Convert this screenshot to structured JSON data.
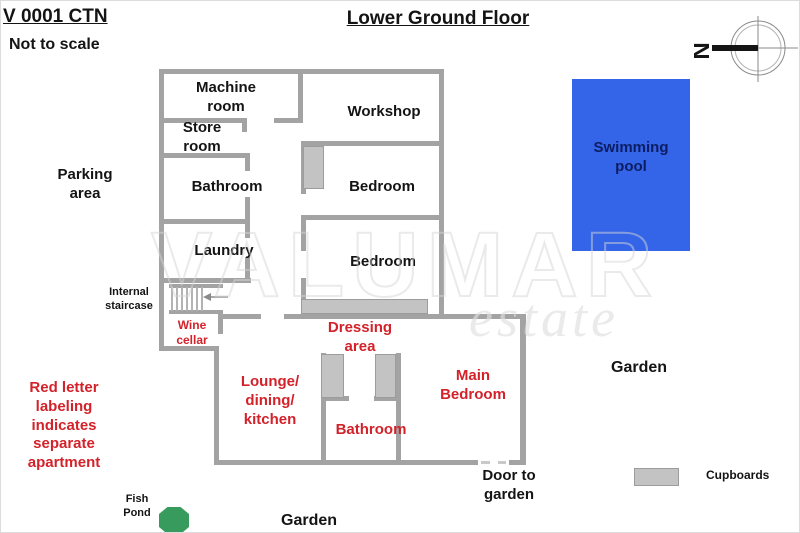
{
  "header": {
    "ref_code": "V 0001 CTN",
    "scale_note": "Not to scale",
    "title": "Lower Ground Floor"
  },
  "compass": {
    "label": "N"
  },
  "watermark": {
    "brand": "VALUMAR",
    "tagline": "estate"
  },
  "plan": {
    "rooms_main_house": {
      "machine_room": "Machine\nroom",
      "workshop": "Workshop",
      "store_room": "Store\nroom",
      "bathroom": "Bathroom",
      "bedroom_upper": "Bedroom",
      "laundry": "Laundry",
      "bedroom_lower": "Bedroom",
      "internal_staircase": "Internal\nstaircase"
    },
    "rooms_apartment": {
      "wine_cellar": "Wine\ncellar",
      "dressing_area": "Dressing\narea",
      "lounge_dining_kitchen": "Lounge/\ndining/\nkitchen",
      "bathroom": "Bathroom",
      "main_bedroom": "Main\nBedroom"
    },
    "outdoor": {
      "parking_area": "Parking\narea",
      "swimming_pool": "Swimming\npool",
      "garden_right": "Garden",
      "garden_bottom": "Garden",
      "fish_pond": "Fish\nPond",
      "door_to_garden": "Door to\ngarden"
    }
  },
  "legend": {
    "cupboards": "Cupboards"
  },
  "note_apartment": "Red letter\nlabeling\nindicates\nseparate\napartment",
  "colors": {
    "wall": "#a3a3a3",
    "cupboard_fill": "#c3c3c3",
    "cupboard_border": "#9c9c9c",
    "apartment_red": "#d3222a",
    "pool_blue": "#3465e8",
    "pool_text": "#0d1d63",
    "pond_green": "#379b5e",
    "ink": "#141414"
  }
}
